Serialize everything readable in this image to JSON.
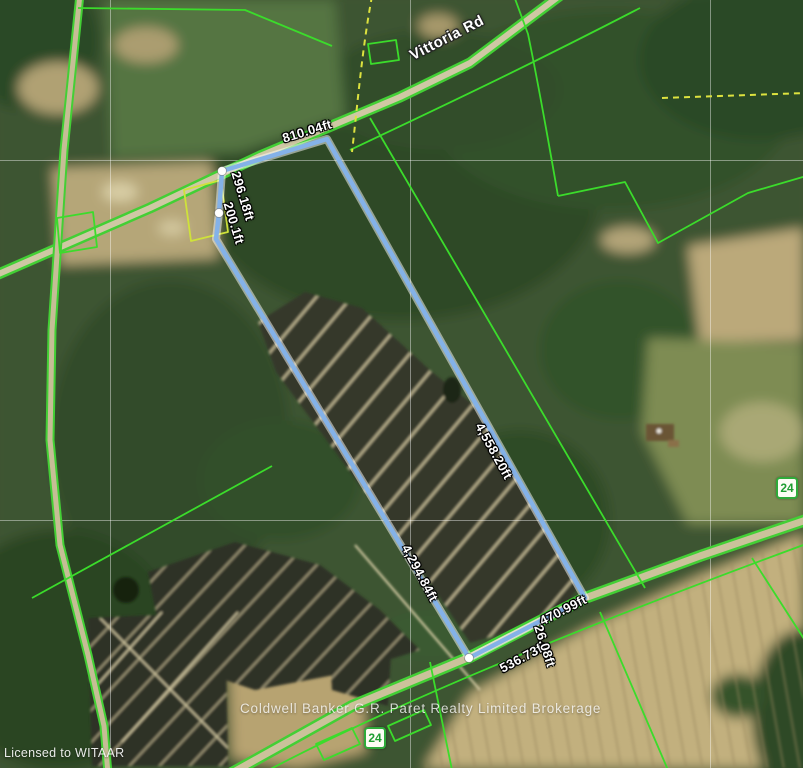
{
  "map": {
    "road_labels": {
      "vittoria": "Vittoria Rd"
    },
    "measurements": {
      "top": "810.04ft",
      "upper_left_a": "296.18ft",
      "upper_left_b": "200.1ft",
      "right": "4,558.20ft",
      "left": "4,294.84ft",
      "bottom_left": "536.73ft",
      "bottom_jog": "26.08ft",
      "bottom_right": "470.99ft"
    },
    "highway_badges": {
      "bottom": "24",
      "right": "24"
    },
    "watermark": "Coldwell Banker G.R. Paret Realty Limited Brokerage",
    "license": "Licensed to WITAAR",
    "colors": {
      "property_boundary": "#84b2e8",
      "parcel_line": "#3bdc2b",
      "dashed_parcel_line": "#dde23f",
      "badge_green": "#2faa3a"
    }
  }
}
